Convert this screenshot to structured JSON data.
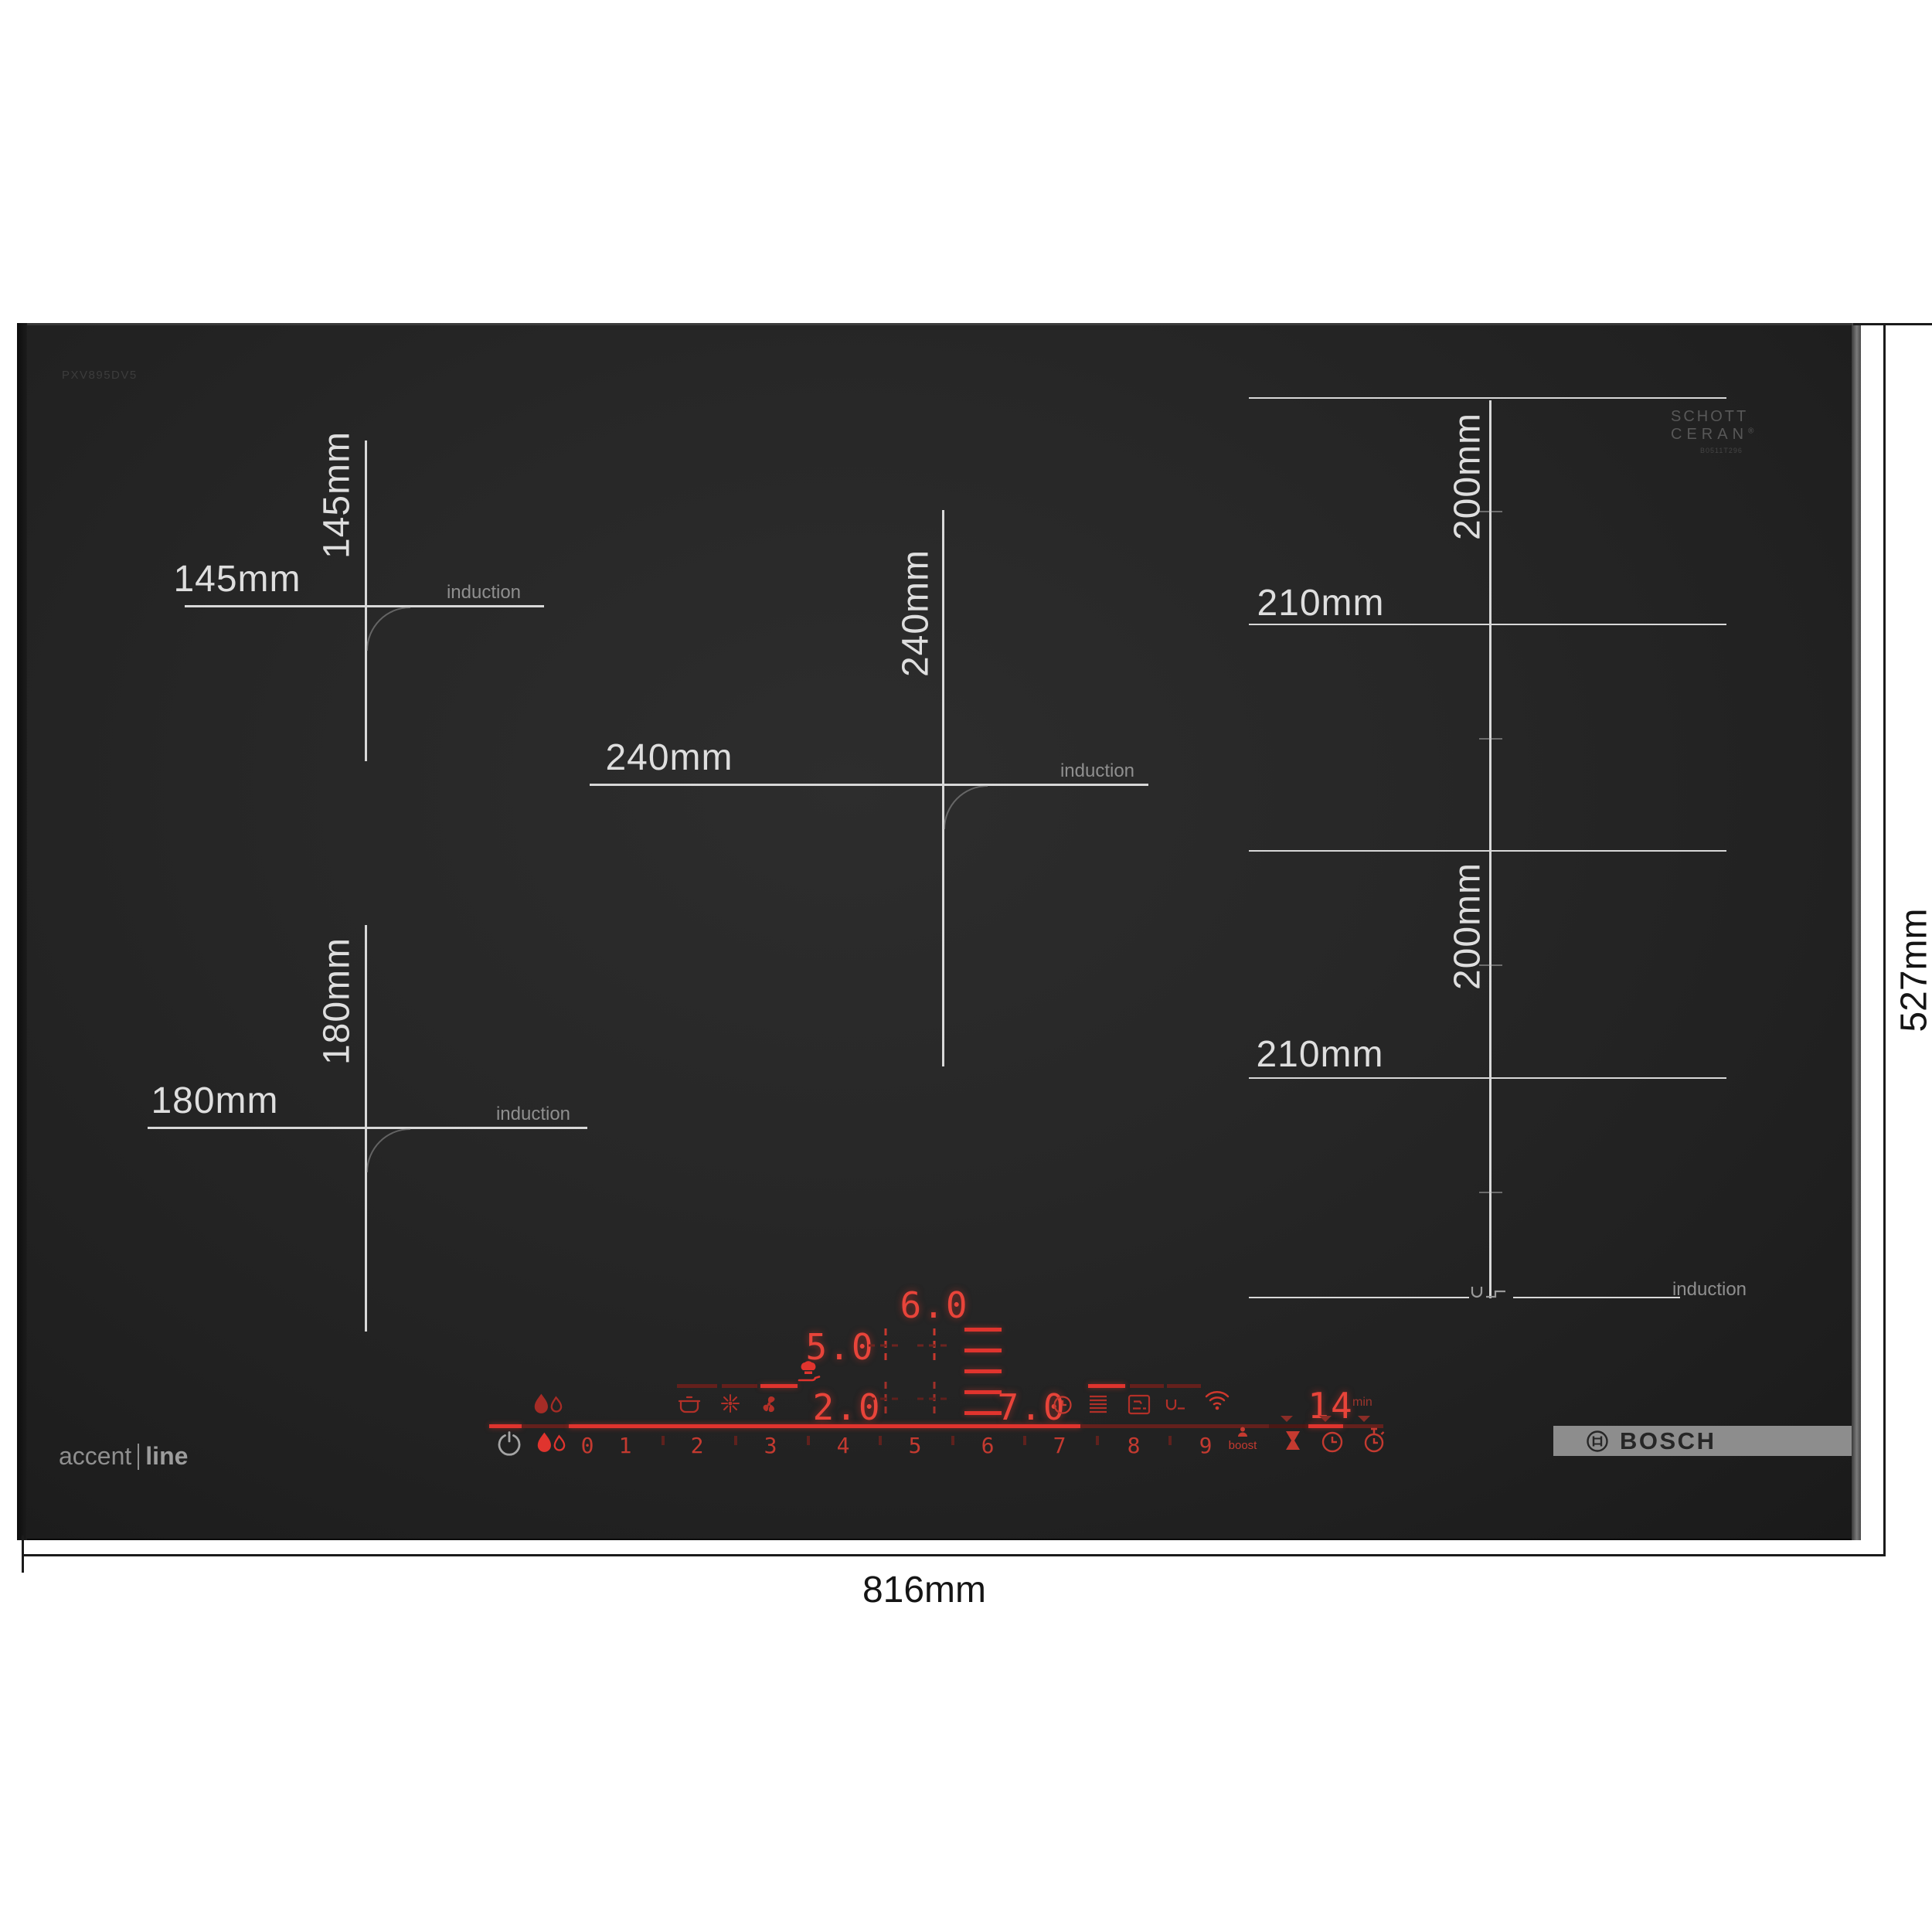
{
  "branding": {
    "model": "PXV895DV5",
    "bosch": "BOSCH",
    "accent": "accent",
    "line": "line",
    "schott_line1": "SCHOTT",
    "schott_line2": "CERAN",
    "registered": "®",
    "schott_serial": "B0511T296"
  },
  "outer_dimensions": {
    "width": "816mm",
    "height": "527mm"
  },
  "zones": {
    "back_left": {
      "w": "145mm",
      "h": "145mm",
      "type": "induction"
    },
    "front_left": {
      "w": "180mm",
      "h": "180mm",
      "type": "induction"
    },
    "center": {
      "w": "240mm",
      "h": "240mm",
      "type": "induction"
    },
    "flex_back": {
      "w": "210mm",
      "h": "200mm"
    },
    "flex_front": {
      "w": "210mm",
      "h": "200mm",
      "type": "induction"
    }
  },
  "display": {
    "levels": {
      "back": "6.0",
      "mid": "5.0",
      "front_left": "2.0",
      "front_right": "7.0"
    },
    "timer": {
      "value": "14",
      "unit": "min"
    }
  },
  "slider": {
    "numbers": [
      "0",
      "1",
      "2",
      "3",
      "4",
      "5",
      "6",
      "7",
      "8",
      "9"
    ],
    "boost": "boost"
  },
  "colors": {
    "glass": "#232323",
    "red_bright": "#e0342e",
    "red_mid": "#b23028",
    "red_dim": "#64201c",
    "measure_line": "#d8d8d8",
    "induction_text": "#8f8f8f",
    "bosch_bar": "#8d8d8d",
    "annotation_black": "#1b1b1b"
  },
  "icons": {
    "power-icon": "circle-with-line power symbol",
    "pan-detection-icon": "two drops",
    "keep-warm-pot-icon": "covered pot",
    "cleaning-sparkle-icon": "starburst",
    "fan-icon": "three-blade fan",
    "fry-sensor-icon": "chef hat over pan",
    "move-lines-icon": "stacked lines",
    "transfer-zone-icon": "square with pan",
    "flex-zone-icon": "u with ledge",
    "wifi-icon": "wifi arcs",
    "boost-person-icon": "person",
    "eggtimer-icon": "hourglass",
    "timer-clock-icon": "clock",
    "alarm-timer-icon": "stopwatch",
    "zone-position-cross-icon": "dashed crosshair",
    "bosch-symbol-icon": "circle with armature"
  }
}
